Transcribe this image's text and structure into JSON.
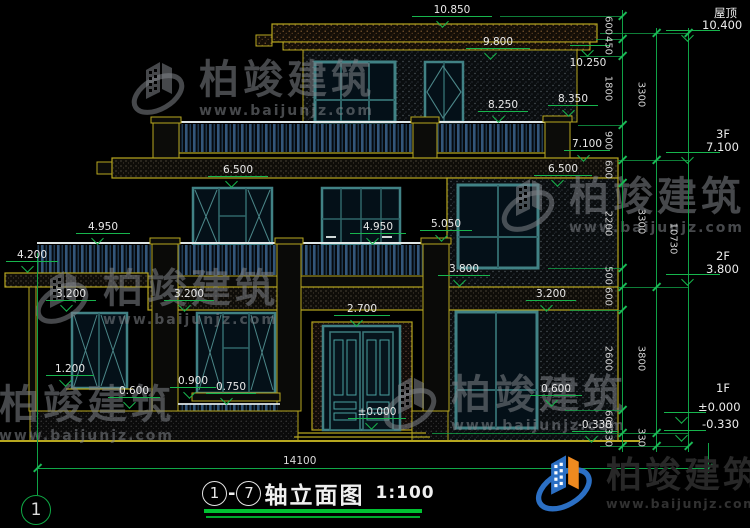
{
  "drawing": {
    "floors": {
      "roof": "屋顶",
      "f3": "3F",
      "f2": "2F",
      "f1": "1F"
    },
    "levels": {
      "v10850": "10.850",
      "v10400": "10.400",
      "v10250": "10.250",
      "v9800": "9.800",
      "v8350": "8.350",
      "v8250": "8.250",
      "v7100": "7.100",
      "v6500": "6.500",
      "v5050": "5.050",
      "v4950": "4.950",
      "v4200": "4.200",
      "v3800": "3.800",
      "v3200": "3.200",
      "v2700": "2.700",
      "v1200": "1.200",
      "v0900": "0.900",
      "v0750": "0.750",
      "v0600": "0.600",
      "v0000": "±0.000",
      "vm0330": "-0.330"
    },
    "dims": {
      "inner": [
        "600",
        "450",
        "1800",
        "900",
        "600",
        "2200",
        "500",
        "600",
        "2600",
        "600",
        "330"
      ],
      "outer": [
        "3300",
        "3300",
        "3800",
        "330"
      ],
      "overall_height": "10730",
      "overall_width": "14100"
    },
    "axis": {
      "left_bubble": "1"
    },
    "title": {
      "axis_start": "1",
      "separator": "-",
      "axis_end": "7",
      "name": "轴立面图",
      "scale": "1:100"
    },
    "watermark": {
      "brand": "柏竣建筑",
      "url": "www.baijunjz.com"
    },
    "logo_colors": {
      "blue": "#2b6fc4",
      "orange": "#ef8a1f"
    }
  }
}
